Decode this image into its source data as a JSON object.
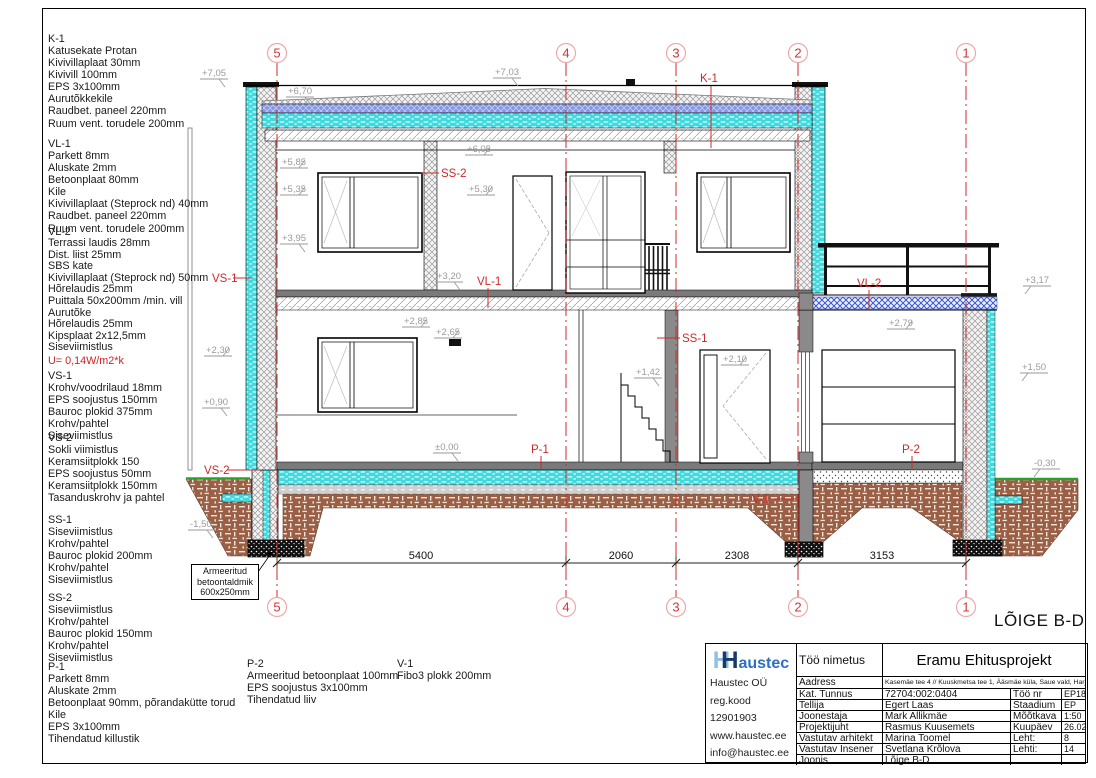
{
  "sheet": {
    "drawing_title": "LÕIGE B-D"
  },
  "specs": [
    {
      "code": "K-1",
      "lines": "Katusekate Protan\nKivivillaplaat 30mm\nKivivill 100mm\nEPS 3x100mm\nAurutõkkekile\nRaudbet. paneel 220mm\nRuum vent. torudele 200mm"
    },
    {
      "code": "VL-1",
      "lines": "Parkett 8mm\nAluskate 2mm\nBetoonplaat 80mm\nKile\nKivivillaplaat (Steprock nd) 40mm\nRaudbet. paneel 220mm\nRuum vent. torudele 200mm"
    },
    {
      "code": "VL-2",
      "lines": "Terrassi laudis 28mm\nDist. liist 25mm\nSBS kate\nKivivillaplaat (Steprock nd) 50mm\nHõrelaudis 25mm\nPuittala 50x200mm /min. vill\nAurutõke\nHõrelaudis 25mm\nKipsplaat 2x12,5mm\nSiseviimistlus",
      "u_value": "U= 0,14W/m2*k"
    },
    {
      "code": "VS-1",
      "lines": "Krohv/voodrilaud 18mm\nEPS soojustus 150mm\nBauroc plokid 375mm\nKrohv/pahtel\nSiseviimistlus"
    },
    {
      "code": "VS-2",
      "lines": "Sokli viimistlus\nKeramsiitplokk 150\nEPS soojustus 50mm\nKeramsiitplokk 150mm\nTasanduskrohv ja pahtel"
    },
    {
      "code": "SS-1",
      "lines": "Siseviimistlus\nKrohv/pahtel\nBauroc plokid 200mm\nKrohv/pahtel\nSiseviimistlus"
    },
    {
      "code": "SS-2",
      "lines": "Siseviimistlus\nKrohv/pahtel\nBauroc plokid 150mm\nKrohv/pahtel\nSiseviimistlus"
    },
    {
      "code": "P-1",
      "lines": "Parkett 8mm\nAluskate 2mm\nBetoonplaat 90mm, põrandakütte torud\nKile\nEPS 3x100mm\nTihendatud killustik"
    },
    {
      "code": "P-2",
      "lines": "Armeeritud betoonplaat 100mm\nEPS soojustus 3x100mm\nTihendatud liiv"
    },
    {
      "code": "V-1",
      "lines": "Fibo3 plokk 200mm"
    }
  ],
  "drawing": {
    "grid_axes": [
      "5",
      "4",
      "3",
      "2",
      "1"
    ],
    "dimensions": [
      "5400",
      "2060",
      "2308",
      "3153"
    ],
    "elevations": [
      "+7,05",
      "+6,70",
      "+7,03",
      "+6,05",
      "+5,85",
      "+5,35",
      "+5,30",
      "+3,95",
      "+3,20",
      "+3,17",
      "+2,85",
      "+2,65",
      "+2,30",
      "+2,10",
      "+2,79",
      "+1,42",
      "+1,50",
      "+0,90",
      "±0,00",
      "-0,30",
      "-1,50"
    ],
    "labels": {
      "k1": "K-1",
      "ss2": "SS-2",
      "vl1": "VL-1",
      "vs1": "VS-1",
      "vs2": "VS-2",
      "ss1": "SS-1",
      "p1": "P-1",
      "p2": "P-2",
      "vl2": "VL-2",
      "v1": "V-1"
    },
    "footing_note": "Armeeritud\nbetoontaldmik\n600x250mm"
  },
  "titleblock": {
    "logo_h1": "H",
    "logo_h2": "H",
    "logo_rest": "austec",
    "company": [
      "Haustec OÜ",
      "reg.kood 12901903",
      "www.haustec.ee",
      "info@haustec.ee"
    ],
    "rows": {
      "work_label": "Töö nimetus",
      "work": "Eramu Ehitusprojekt",
      "address_label": "Aadress",
      "address": "Kasemäe tee 4 // Kuuskmetsa tee 1, Ääsmäe küla, Saue vald, Harjumaa",
      "cadastral_label": "Kat. Tunnus",
      "cadastral": "72704:002:0404",
      "jobno_label": "Töö nr",
      "jobno": "EP18-07",
      "client_label": "Tellija",
      "client": "Egert Laas",
      "stage_label": "Staadium",
      "stage": "EP",
      "drafter_label": "Joonestaja",
      "drafter": "Mark Allikmäe",
      "scale_label": "Mõõtkava",
      "scale": "1:50",
      "pm_label": "Projektijuht",
      "pm": "Rasmus Kuusemets",
      "date_label": "Kuupäev",
      "date": "26.02.18",
      "architect_label": "Vastutav arhitekt",
      "architect": "Marina Toomel",
      "sheet_label": "Leht:",
      "sheet": "8",
      "engineer_label": "Vastutav Insener",
      "engineer": "Svetlana Krõlova",
      "sheets_label": "Lehti:",
      "sheets": "14",
      "drawing_label": "Joonis",
      "drawing": "Lõige B-D"
    }
  },
  "colors": {
    "accent_red": "#cc2a2a",
    "insulation_cyan": "#3fd9de",
    "roof_blue": "#8496e4",
    "earth_brown": "#9a5f45",
    "grade_green": "#2ca02c",
    "logo_navy": "#173a66",
    "logo_blue": "#2d6fc2"
  }
}
